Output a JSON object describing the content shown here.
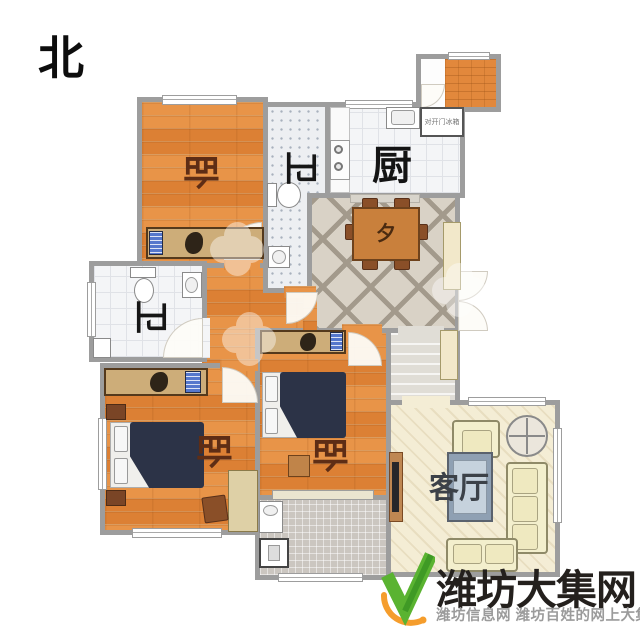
{
  "compass": {
    "north_label": "北"
  },
  "rooms": {
    "bedroom_north": {
      "label": "卧"
    },
    "bathroom_north": {
      "label": "卫"
    },
    "kitchen": {
      "label": "厨"
    },
    "dining": {
      "label": "夕"
    },
    "bathroom_west": {
      "label": "卫"
    },
    "bedroom_middle": {
      "label": "卧"
    },
    "bedroom_southwest": {
      "label": "卧"
    },
    "living_room": {
      "label": "客厅"
    }
  },
  "appliances": {
    "refrigerator_label": "对开门冰箱"
  },
  "watermark": {
    "title": "潍坊大集网",
    "subtitle": "潍坊信息网 潍坊百姓的网上大集"
  },
  "colors": {
    "wood_floor": "#e2883c",
    "wall": "#9d9d9d",
    "bed": "#2c3347",
    "dining_table": "#c9803c",
    "sofa": "#f3efcd",
    "label_maroon": "#5e2d15",
    "label_dark": "#1d1d1d",
    "watermark_green": "#5ab331",
    "watermark_orange": "#f59d2c"
  }
}
